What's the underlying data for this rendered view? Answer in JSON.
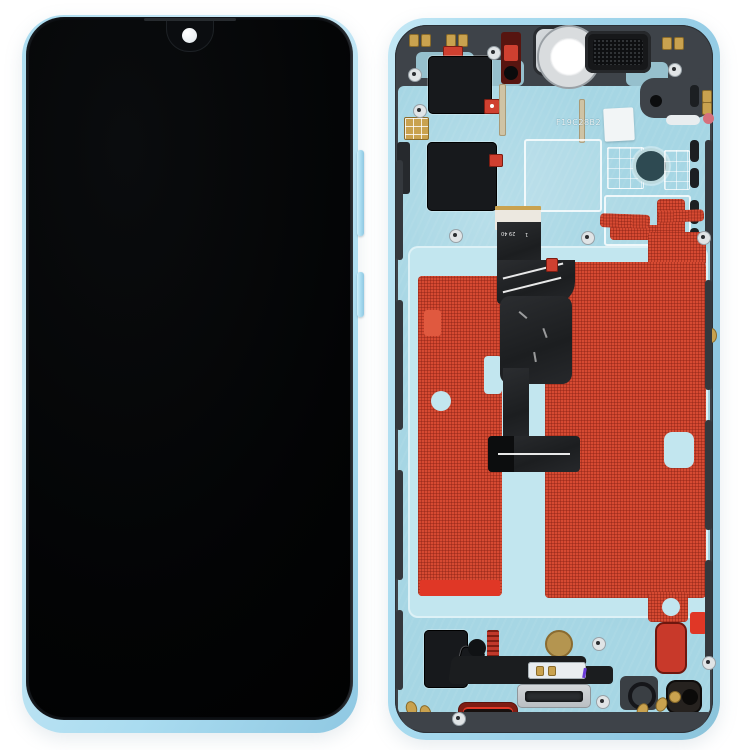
{
  "product": {
    "left_unit": {
      "view": "front display assembly, screen off",
      "notch_style": "waterdrop with camera dot"
    },
    "right_unit": {
      "view": "rear of middle frame with flex cable and adhesive",
      "etched_code": "F19C28B2",
      "flex_label_text": "FWJ40RV VISUM",
      "flex_marking_top": "29 40",
      "flex_marking_bottom": "1"
    }
  },
  "colors": {
    "background": "#ffffff",
    "frame_blue": "#aadcf0",
    "frame_blue_deep": "#8fc8e2",
    "plate_teal": "#a6d6e4",
    "adhesive_light": "#c2e6ef",
    "red_adhesive": "#d64a32",
    "red_bright": "#e03726",
    "red_conn": "#cf4030",
    "metal_dark": "#3e4349",
    "graphite": "#17191c",
    "flex_black": "#232528",
    "gold": "#c9a24f",
    "silver": "#ccd1d4",
    "pink_dot": "#d6707c",
    "screen_black": "#050607"
  }
}
